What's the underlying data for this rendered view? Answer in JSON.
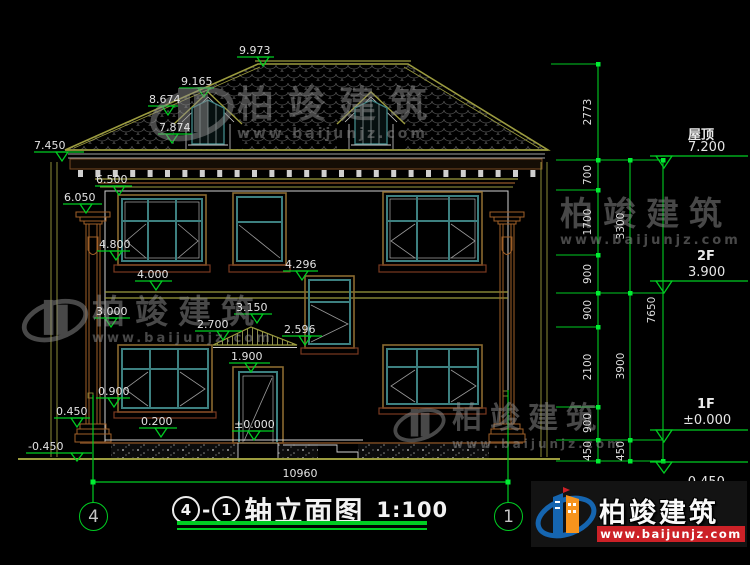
{
  "drawing_title": {
    "axis_from": "4",
    "axis_to": "1",
    "dash": "-",
    "name": "轴立面图",
    "scale": "1:100"
  },
  "axes": {
    "left": "4",
    "right": "1"
  },
  "overall_width": "10960",
  "markers": [
    "9.973",
    "9.165",
    "8.674",
    "7.874",
    "7.450",
    "6.500",
    "6.050",
    "4.800",
    "4.000",
    "3.000",
    "4.296",
    "3.150",
    "2.700",
    "2.596",
    "1.900",
    "0.900",
    "0.450",
    "0.200",
    "±0.000",
    "-0.450"
  ],
  "chain1": [
    "2773",
    "700",
    "1700",
    "900",
    "900",
    "2100",
    "900",
    "450"
  ],
  "chain2": [
    "3300",
    "3900",
    "450"
  ],
  "chain3": [
    "7650"
  ],
  "elevation_flags": [
    {
      "label": "屋顶",
      "value": "7.200"
    },
    {
      "label": "2F",
      "value": "3.900"
    },
    {
      "label": "1F",
      "value": "±0.000"
    },
    {
      "label": "",
      "value": "-0.450"
    }
  ],
  "watermark": {
    "brand": "柏竣建筑",
    "url": "www.baijunjz.com"
  },
  "logo": {
    "brand": "柏竣建筑",
    "url": "www.baijunjz.com"
  },
  "colors": {
    "dimension_green": "#00cc22",
    "cad_yellow": "#9c9c3f",
    "window_teal": "#3d8080",
    "trim_brown": "#a06028",
    "logo_blue": "#1565b0",
    "logo_orange": "#f7941d",
    "logo_red": "#cc2127"
  }
}
